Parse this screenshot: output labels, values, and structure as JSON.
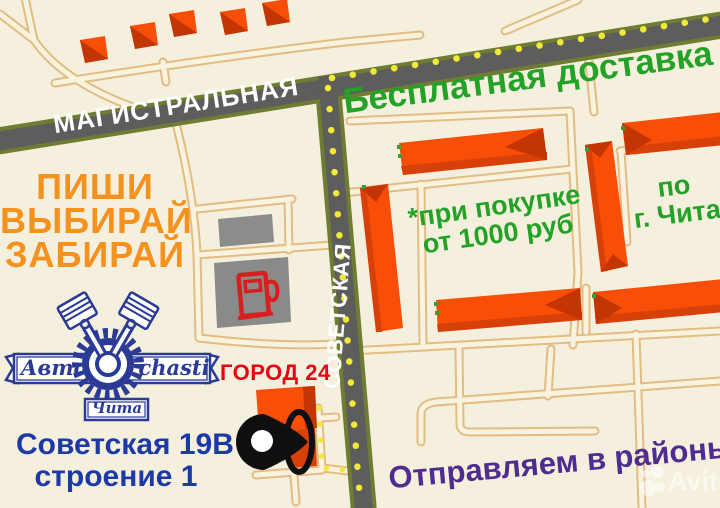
{
  "colors": {
    "bg": "#F5F0DD",
    "road": "#5D5D5B",
    "road-edge": "#6F7D33",
    "dot": "#F2E937",
    "path-edge": "#E2BC83",
    "path-fill": "#F8F2DE",
    "bld": "#F84E07",
    "bld-dark": "#C33502",
    "gray-bld": "#8C8C8A",
    "green": "#23A228",
    "orange": "#F5921E",
    "blue": "#1C3AA6",
    "navy": "#2B3A94",
    "red": "#E30613",
    "purple": "#4F2C90",
    "pump-red": "#D81F1F"
  },
  "streets": {
    "main_horizontal": "МАГИСТРАЛЬНАЯ",
    "main_vertical": "СОВЕТСКАЯ"
  },
  "promo": {
    "free_delivery": "Бесплатная доставка",
    "condition_line1": "*при покупке",
    "condition_line2": "от 1000 руб",
    "area_line1": "по",
    "area_line2": "г. Чита",
    "slogan_line1": "ПИШИ",
    "slogan_line2": "ВЫБИРАЙ",
    "slogan_line3": "ЗАБИРАЙ",
    "shipping": "Отправляем в районы"
  },
  "landmark": {
    "label": "ГОРОД 24"
  },
  "address": {
    "line1": "Советская 19В",
    "line2": "строение 1"
  },
  "logo": {
    "word_left": "Авто",
    "word_right": "chasti",
    "city": "Чита"
  },
  "watermark": {
    "label": "Avito"
  },
  "icons": {
    "fuel_pump": "fuel-pump-icon",
    "location_pin": "location-pin-icon",
    "watermark_dots": "avito-dots-icon"
  }
}
